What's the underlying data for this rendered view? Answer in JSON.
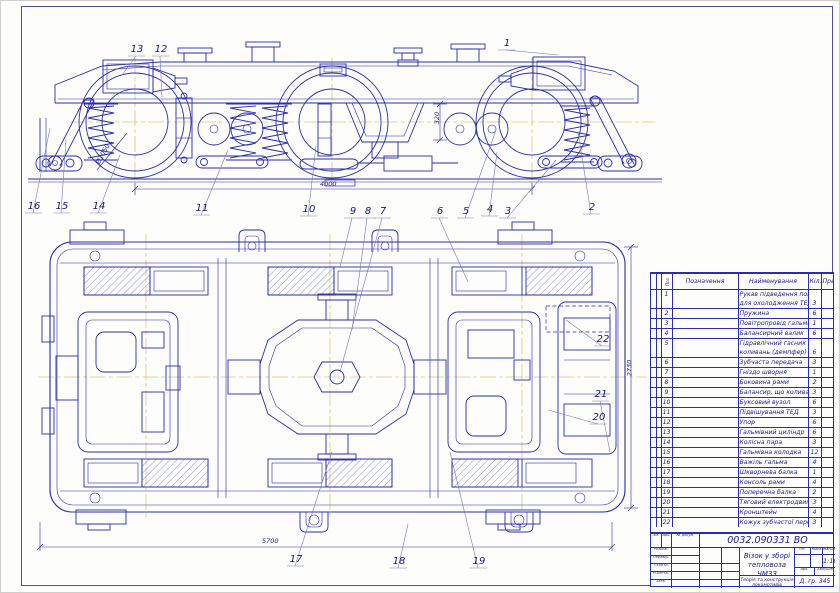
{
  "drawing": {
    "line_color": "#2c2cb0",
    "centerline_color": "#d8ca80",
    "side_view_callouts": [
      {
        "n": "13",
        "lx": 130,
        "ly": 44,
        "tx": 122,
        "ty": 75
      },
      {
        "n": "12",
        "lx": 154,
        "ly": 44,
        "tx": 162,
        "ty": 97
      },
      {
        "n": "1",
        "lx": 500,
        "ly": 38,
        "tx": 558,
        "ty": 55
      },
      {
        "n": "16",
        "lx": 27,
        "ly": 201,
        "tx": 50,
        "ty": 128
      },
      {
        "n": "15",
        "lx": 55,
        "ly": 201,
        "tx": 66,
        "ty": 140
      },
      {
        "n": "14",
        "lx": 92,
        "ly": 201,
        "tx": 120,
        "ty": 155
      },
      {
        "n": "11",
        "lx": 195,
        "ly": 203,
        "tx": 228,
        "ty": 150
      },
      {
        "n": "10",
        "lx": 302,
        "ly": 204,
        "tx": 316,
        "ty": 146
      },
      {
        "n": "9",
        "lx": 346,
        "ly": 206,
        "tx": 340,
        "ty": 267
      },
      {
        "n": "8",
        "lx": 361,
        "ly": 206,
        "tx": 352,
        "ty": 330
      },
      {
        "n": "7",
        "lx": 376,
        "ly": 206,
        "tx": 340,
        "ty": 372
      },
      {
        "n": "6",
        "lx": 433,
        "ly": 206,
        "tx": 468,
        "ty": 282
      },
      {
        "n": "5",
        "lx": 459,
        "ly": 206,
        "tx": 496,
        "ty": 130
      },
      {
        "n": "4",
        "lx": 483,
        "ly": 204,
        "tx": 497,
        "ty": 152
      },
      {
        "n": "3",
        "lx": 501,
        "ly": 206,
        "tx": 556,
        "ty": 160
      },
      {
        "n": "2",
        "lx": 585,
        "ly": 202,
        "tx": 578,
        "ty": 132
      }
    ],
    "plan_view_callouts": [
      {
        "n": "22",
        "lx": 596,
        "ly": 334,
        "tx": 566,
        "ty": 320
      },
      {
        "n": "21",
        "lx": 594,
        "ly": 389,
        "tx": 610,
        "ty": 452
      },
      {
        "n": "20",
        "lx": 592,
        "ly": 412,
        "tx": 548,
        "ty": 410
      },
      {
        "n": "17",
        "lx": 289,
        "ly": 554,
        "tx": 332,
        "ty": 452
      },
      {
        "n": "18",
        "lx": 392,
        "ly": 556,
        "tx": 408,
        "ty": 524
      },
      {
        "n": "19",
        "lx": 472,
        "ly": 556,
        "tx": 450,
        "ty": 452
      }
    ],
    "dimensions": [
      {
        "label": "320",
        "x": 431,
        "y": 114,
        "rot": -90
      },
      {
        "label": "4000",
        "x": 320,
        "y": 180,
        "rot": 0
      },
      {
        "label": "Ø1050",
        "x": 92,
        "y": 150,
        "rot": -62
      },
      {
        "label": "5700",
        "x": 262,
        "y": 537,
        "rot": 0
      },
      {
        "label": "2730",
        "x": 621,
        "y": 364,
        "rot": -90
      }
    ]
  },
  "spec_table": {
    "headers": {
      "format": "Формат",
      "zone": "Зона",
      "pos": "Поз.",
      "designation": "Позначення",
      "name": "Найменування",
      "qty": "Кіл.",
      "note": "Прим."
    },
    "rows": [
      {
        "pos": "1",
        "name": "Рукав підведення повітря",
        "name2": "для охолодження ТЕД",
        "qty": "3"
      },
      {
        "pos": "2",
        "name": "Пружина",
        "qty": "6"
      },
      {
        "pos": "3",
        "name": "Повітропровід гальма",
        "qty": "1"
      },
      {
        "pos": "4",
        "name": "Балансирний валик",
        "qty": "6"
      },
      {
        "pos": "5",
        "name": "Гідравлічний гасник",
        "name2": "коливань (демпфер)",
        "qty": "6"
      },
      {
        "pos": "6",
        "name": "Зубчаста передача",
        "qty": "3"
      },
      {
        "pos": "7",
        "name": "Гніздо шворня",
        "qty": "1"
      },
      {
        "pos": "8",
        "name": "Боковина рами",
        "qty": "2"
      },
      {
        "pos": "9",
        "name": "Балансир, що коливається",
        "qty": "3"
      },
      {
        "pos": "10",
        "name": "Буксовий вузол",
        "qty": "6"
      },
      {
        "pos": "11",
        "name": "Підвішування ТЕД",
        "qty": "3"
      },
      {
        "pos": "12",
        "name": "Упор",
        "qty": "6"
      },
      {
        "pos": "13",
        "name": "Гальмівний циліндр",
        "qty": "6"
      },
      {
        "pos": "14",
        "name": "Колісна пара",
        "qty": "3"
      },
      {
        "pos": "15",
        "name": "Гальмівна колодка",
        "qty": "12"
      },
      {
        "pos": "16",
        "name": "Важіль гальма",
        "qty": "4"
      },
      {
        "pos": "17",
        "name": "Шкворнева балка",
        "qty": "1"
      },
      {
        "pos": "18",
        "name": "Консоль рами",
        "qty": "4"
      },
      {
        "pos": "19",
        "name": "Поперечна балка",
        "qty": "2"
      },
      {
        "pos": "20",
        "name": "Тяговий електродвигун",
        "qty": "3"
      },
      {
        "pos": "21",
        "name": "Кронштейн",
        "qty": "4"
      },
      {
        "pos": "22",
        "name": "Кожух зубчастої передачі",
        "qty": "3"
      }
    ]
  },
  "title_block": {
    "doc_number": "0032.090331  ВО",
    "title_line1": "Візок у зборі",
    "title_line2": "тепловоза ЧМЗЗ",
    "subject_line1": "Теорія та конструкція",
    "subject_line2": "локомотивів",
    "group": "Д. гр. 345",
    "scale_value": "1:10",
    "labels": {
      "change": "Зм.",
      "sheet_col": "Арк.",
      "doc_col": "№ докум.",
      "sign": "Підпис",
      "date": "Дата",
      "developed": "Розроб.",
      "checked": "Перевір.",
      "tcontrol": "Т.контр.",
      "ncontrol": "Н.контр.",
      "approved": "Затв.",
      "lit": "Літ.",
      "mass": "Маса",
      "scale": "Масштаб",
      "sheet": "Арк.",
      "sheets": "Аркушів"
    }
  }
}
